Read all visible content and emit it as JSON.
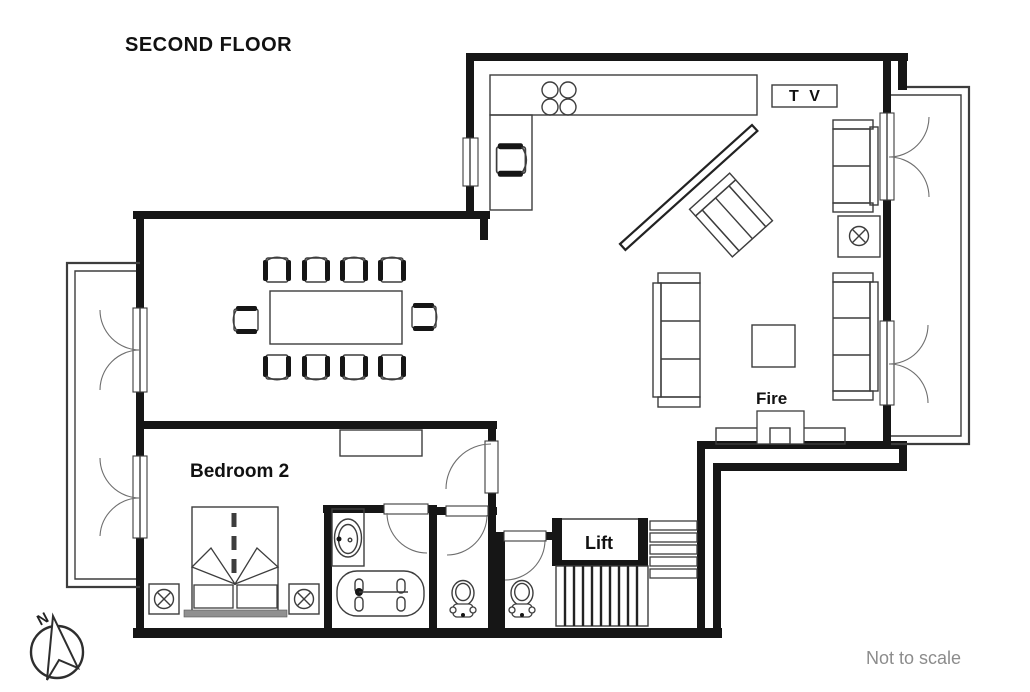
{
  "title": "SECOND FLOOR",
  "plan": {
    "rooms": {
      "bedroom2": "Bedroom 2",
      "lift": "Lift"
    },
    "features": {
      "fireplace": "Fire",
      "tv_unit": "T V"
    },
    "compass": {
      "north": "N"
    },
    "footnote": "Not to scale"
  },
  "icons": {
    "lamp": "circle-with-x",
    "stove": "four-burner-circles",
    "compass": "north-needle-arrow",
    "stairs": "striped-treads"
  },
  "colors": {
    "wall": "#161616",
    "line": "#3d3d3d",
    "soft": "#6e6e6e",
    "muted": "#8c8c8c",
    "headboard": "#909090",
    "bg": "#ffffff"
  }
}
